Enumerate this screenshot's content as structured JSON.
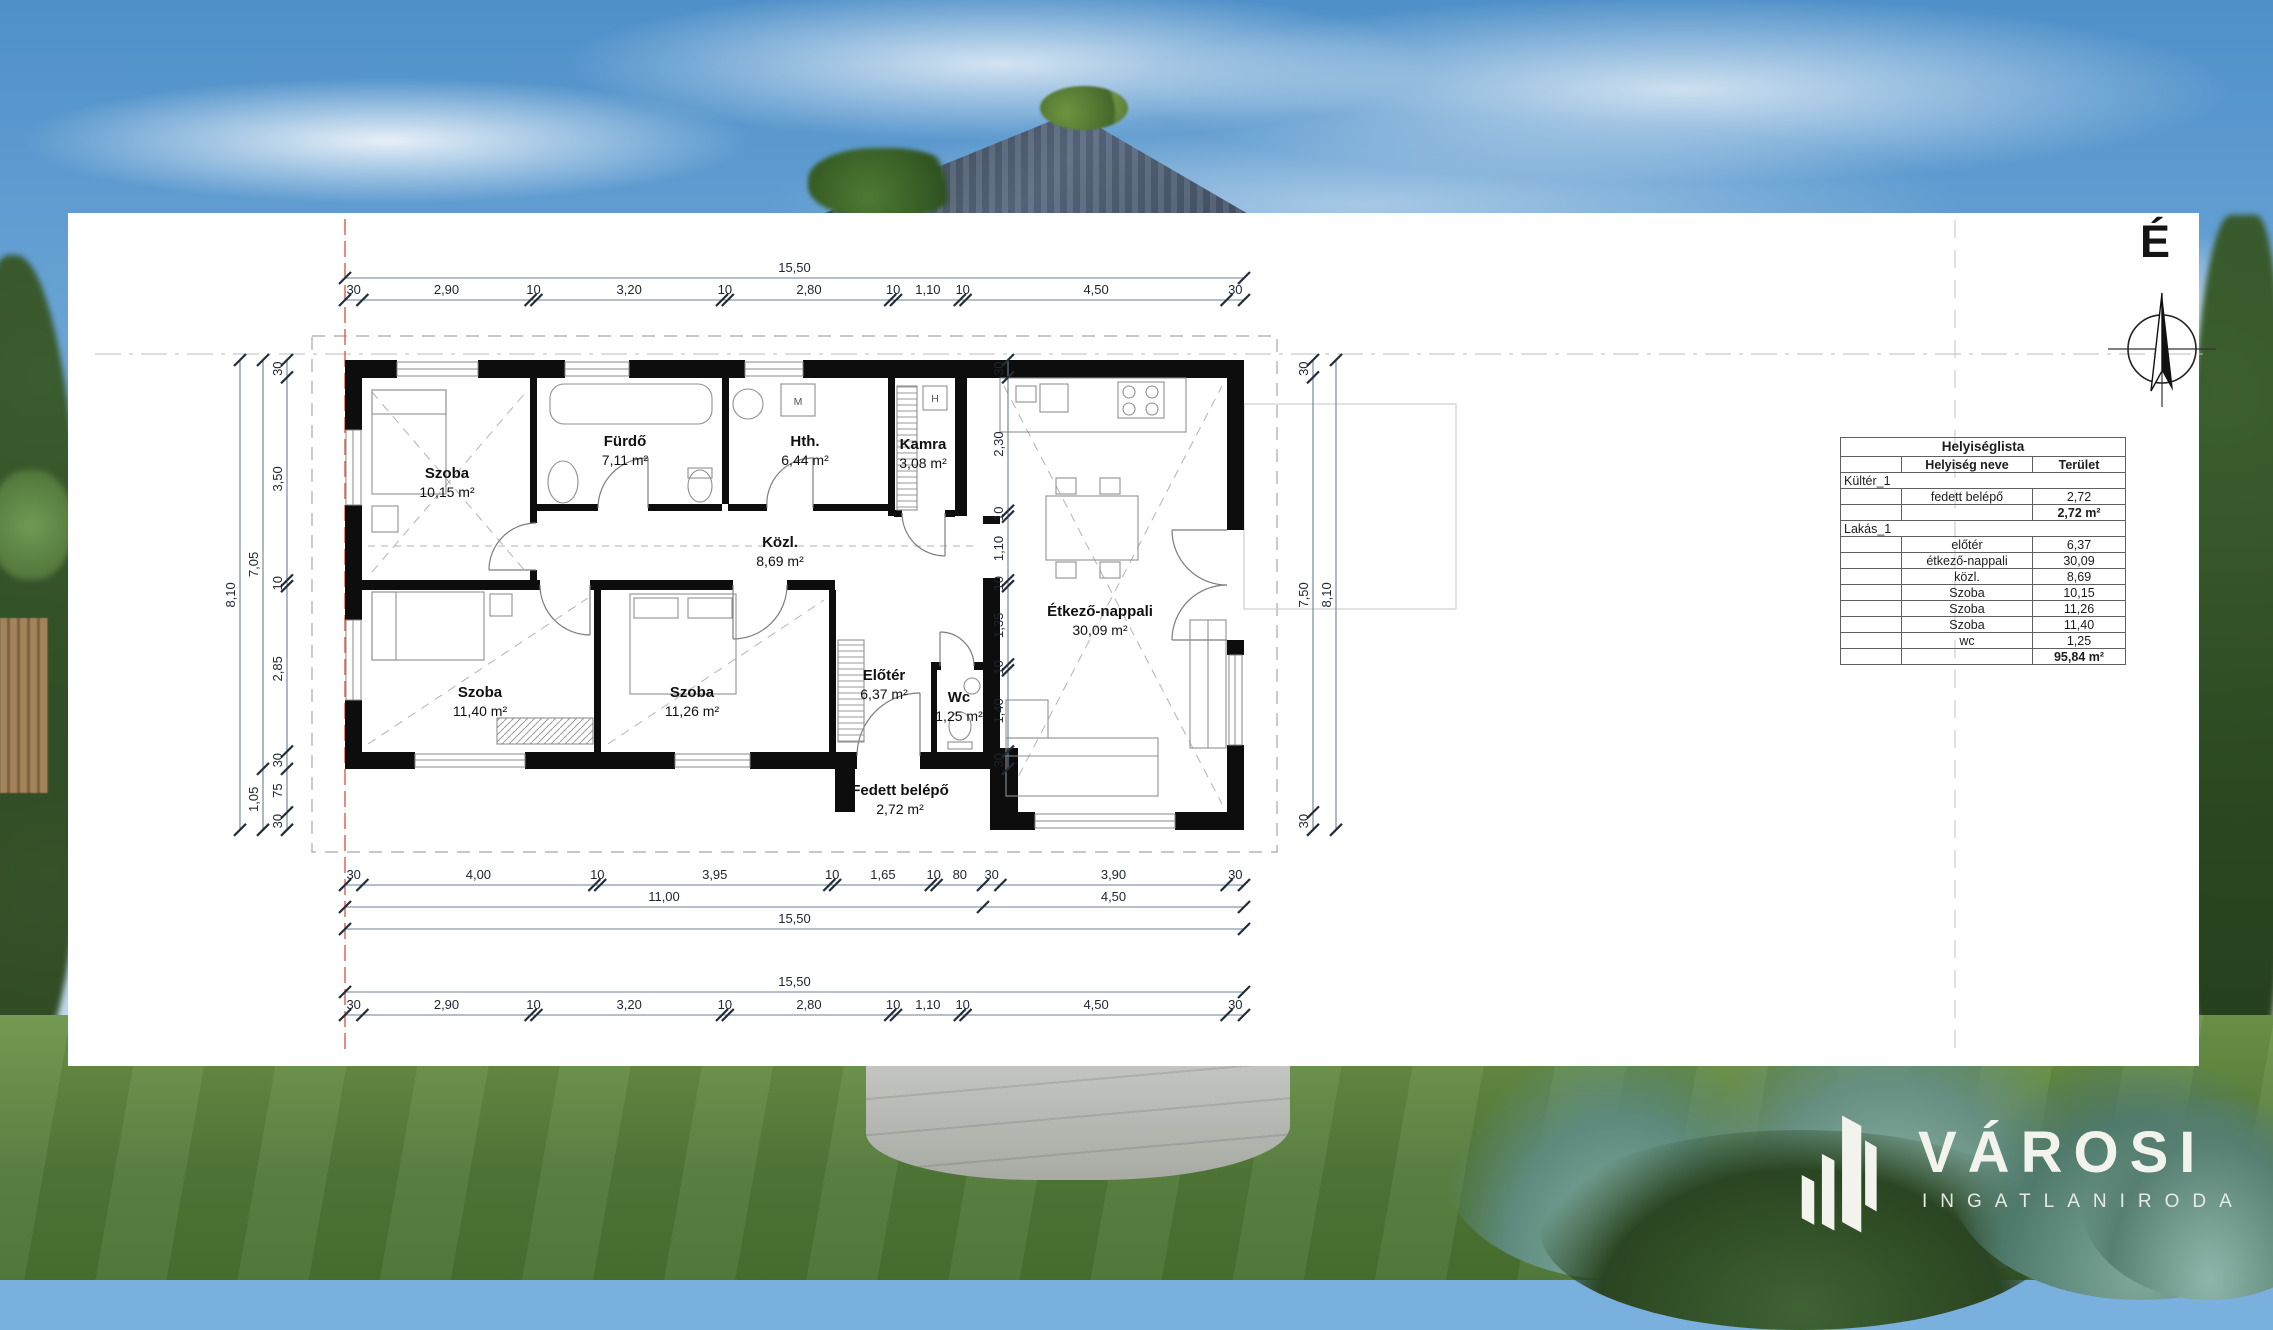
{
  "scene": {
    "sky_top": "#4f90c9",
    "sky_horizon": "#dfeaf3",
    "grass": "#507737",
    "roof": "#47556a",
    "panel_bg": "#ffffff",
    "accent_red_line": "#dd5a4b"
  },
  "north": {
    "label": "É"
  },
  "plan": {
    "labels": {
      "washer": "M",
      "boiler": "H"
    },
    "rooms": [
      {
        "name": "Szoba",
        "area": "10,15 m²",
        "x": 447,
        "y": 478
      },
      {
        "name": "Fürdő",
        "area": "7,11 m²",
        "x": 625,
        "y": 446
      },
      {
        "name": "Hth.",
        "area": "6,44 m²",
        "x": 805,
        "y": 446
      },
      {
        "name": "Kamra",
        "area": "3,08 m²",
        "x": 923,
        "y": 449
      },
      {
        "name": "Közl.",
        "area": "8,69 m²",
        "x": 780,
        "y": 547
      },
      {
        "name": "Étkező-nappali",
        "area": "30,09 m²",
        "x": 1100,
        "y": 616
      },
      {
        "name": "Szoba",
        "area": "11,40 m²",
        "x": 480,
        "y": 697
      },
      {
        "name": "Szoba",
        "area": "11,26 m²",
        "x": 692,
        "y": 697
      },
      {
        "name": "Előtér",
        "area": "6,37 m²",
        "x": 884,
        "y": 680
      },
      {
        "name": "Wc",
        "area": "1,25 m²",
        "x": 959,
        "y": 702
      },
      {
        "name": "Fedett belépő",
        "area": "2,72 m²",
        "x": 900,
        "y": 795
      }
    ],
    "dim_chains": [
      {
        "id": "top-total",
        "dir": "h",
        "pos": 278,
        "segs": [
          [
            "15,50",
            0,
            15.5
          ]
        ]
      },
      {
        "id": "top-detail",
        "dir": "h",
        "pos": 300,
        "segs": [
          [
            "30",
            0,
            0.3
          ],
          [
            "2,90",
            0.3,
            3.2
          ],
          [
            "10",
            3.2,
            3.3
          ],
          [
            "3,20",
            3.3,
            6.5
          ],
          [
            "10",
            6.5,
            6.6
          ],
          [
            "2,80",
            6.6,
            9.4
          ],
          [
            "10",
            9.4,
            9.5
          ],
          [
            "1,10",
            9.5,
            10.6
          ],
          [
            "10",
            10.6,
            10.7
          ],
          [
            "4,50",
            10.7,
            15.2
          ],
          [
            "30",
            15.2,
            15.5
          ]
        ]
      },
      {
        "id": "bottom-detail",
        "dir": "h",
        "pos": 885,
        "segs": [
          [
            "30",
            0,
            0.3
          ],
          [
            "4,00",
            0.3,
            4.3
          ],
          [
            "10",
            4.3,
            4.4
          ],
          [
            "3,95",
            4.4,
            8.35
          ],
          [
            "10",
            8.35,
            8.45
          ],
          [
            "1,65",
            8.45,
            10.1
          ],
          [
            "10",
            10.1,
            10.2
          ],
          [
            "80",
            10.2,
            11.0
          ],
          [
            "30",
            11.0,
            11.3
          ],
          [
            "3,90",
            11.3,
            15.2
          ],
          [
            "30",
            15.2,
            15.5
          ]
        ]
      },
      {
        "id": "bottom-mid",
        "dir": "h",
        "pos": 907,
        "segs": [
          [
            "11,00",
            0,
            11.0
          ],
          [
            "4,50",
            11.0,
            15.5
          ]
        ]
      },
      {
        "id": "bottom-total",
        "dir": "h",
        "pos": 929,
        "segs": [
          [
            "15,50",
            0,
            15.5
          ]
        ]
      },
      {
        "id": "site-total",
        "dir": "h",
        "pos": 992,
        "segs": [
          [
            "15,50",
            0,
            15.5
          ]
        ]
      },
      {
        "id": "site-detail",
        "dir": "h",
        "pos": 1015,
        "segs": [
          [
            "30",
            0,
            0.3
          ],
          [
            "2,90",
            0.3,
            3.2
          ],
          [
            "10",
            3.2,
            3.3
          ],
          [
            "3,20",
            3.3,
            6.5
          ],
          [
            "10",
            6.5,
            6.6
          ],
          [
            "2,80",
            6.6,
            9.4
          ],
          [
            "10",
            9.4,
            9.5
          ],
          [
            "1,10",
            9.5,
            10.6
          ],
          [
            "10",
            10.6,
            10.7
          ],
          [
            "4,50",
            10.7,
            15.2
          ],
          [
            "30",
            15.2,
            15.5
          ]
        ]
      },
      {
        "id": "left-inner",
        "dir": "v",
        "pos": 287,
        "segs": [
          [
            "30",
            0,
            0.3
          ],
          [
            "3,50",
            0.3,
            3.8
          ],
          [
            "10",
            3.8,
            3.9
          ],
          [
            "2,85",
            3.9,
            6.75
          ],
          [
            "30",
            6.75,
            7.05
          ],
          [
            "75",
            7.05,
            7.8
          ],
          [
            "30",
            7.8,
            8.1
          ]
        ]
      },
      {
        "id": "left-mid",
        "dir": "v",
        "pos": 263,
        "segs": [
          [
            "7,05",
            0,
            7.05
          ],
          [
            "1,05",
            7.05,
            8.1
          ]
        ]
      },
      {
        "id": "left-outer",
        "dir": "v",
        "pos": 240,
        "segs": [
          [
            "8,10",
            0,
            8.1
          ]
        ]
      },
      {
        "id": "right-inner",
        "dir": "v",
        "pos": 1313,
        "segs": [
          [
            "30",
            0,
            0.3
          ],
          [
            "7,50",
            0.3,
            7.8
          ],
          [
            "30",
            7.8,
            8.1
          ]
        ]
      },
      {
        "id": "right-outer",
        "dir": "v",
        "pos": 1336,
        "segs": [
          [
            "8,10",
            0,
            8.1
          ]
        ]
      },
      {
        "id": "interior",
        "dir": "v",
        "pos": 1008,
        "segs": [
          [
            "30",
            0,
            0.3
          ],
          [
            "2,30",
            0.3,
            2.6
          ],
          [
            "10",
            2.6,
            2.7
          ],
          [
            "1,10",
            2.7,
            3.8
          ],
          [
            "10",
            3.8,
            3.9
          ],
          [
            "1,35",
            3.9,
            5.25
          ],
          [
            "10",
            5.25,
            5.35
          ],
          [
            "1,40",
            5.35,
            6.75
          ],
          [
            "30",
            6.75,
            7.05
          ]
        ]
      }
    ]
  },
  "room_table": {
    "title": "Helyiséglista",
    "columns": [
      "",
      "Helyiség neve",
      "Terület"
    ],
    "sections": [
      {
        "group": "Kültér_1",
        "rows": [
          {
            "name": "fedett belépő",
            "area": "2,72"
          }
        ],
        "subtotal": "2,72 m²"
      },
      {
        "group": "Lakás_1",
        "rows": [
          {
            "name": "előtér",
            "area": "6,37"
          },
          {
            "name": "étkező-nappali",
            "area": "30,09"
          },
          {
            "name": "közl.",
            "area": "8,69"
          },
          {
            "name": "Szoba",
            "area": "10,15"
          },
          {
            "name": "Szoba",
            "area": "11,26"
          },
          {
            "name": "Szoba",
            "area": "11,40"
          },
          {
            "name": "wc",
            "area": "1,25"
          }
        ],
        "subtotal": "95,84 m²"
      }
    ]
  },
  "logo": {
    "brand": "VÁROSI",
    "subtitle": "INGATLANIRODA"
  }
}
